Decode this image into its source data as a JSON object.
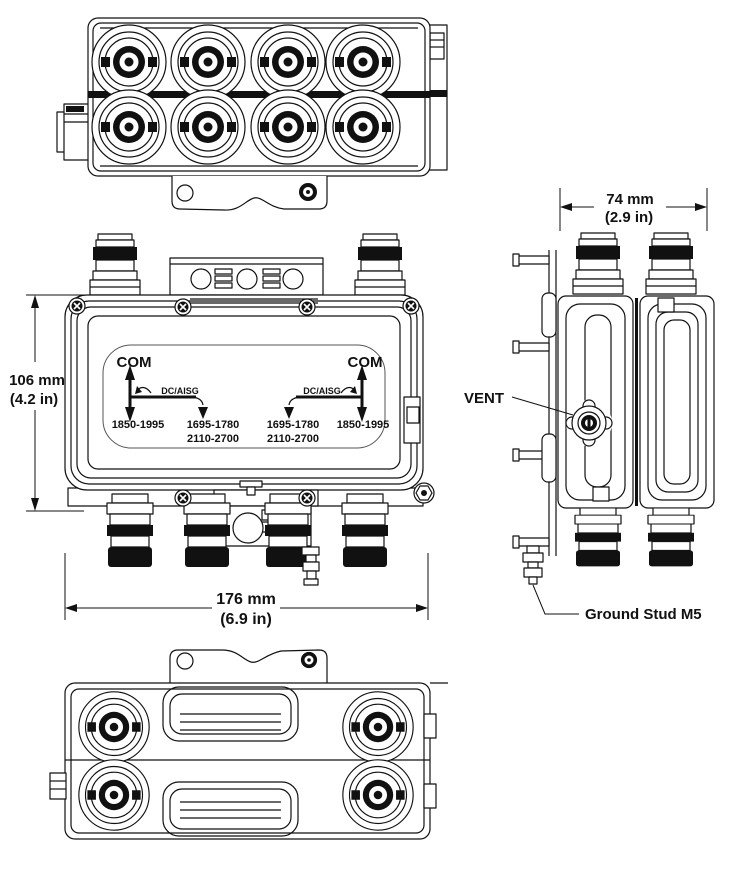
{
  "page": {
    "background": "#ffffff",
    "line_color": "#111111"
  },
  "views": {
    "front_view": {
      "label_panel": {
        "com": "COM",
        "dc_aisg": "DC/AISG",
        "band_1850": "1850-1995",
        "band_1695": "1695-1780",
        "band_2110": "2110-2700"
      }
    }
  },
  "dimensions": {
    "height": {
      "metric": "106 mm",
      "imperial": "(4.2 in)"
    },
    "width": {
      "metric": "176 mm",
      "imperial": "(6.9 in)"
    },
    "depth": {
      "metric": "74 mm",
      "imperial": "(2.9 in)"
    }
  },
  "callouts": {
    "vent": "VENT",
    "ground_stud": "Ground Stud M5"
  }
}
